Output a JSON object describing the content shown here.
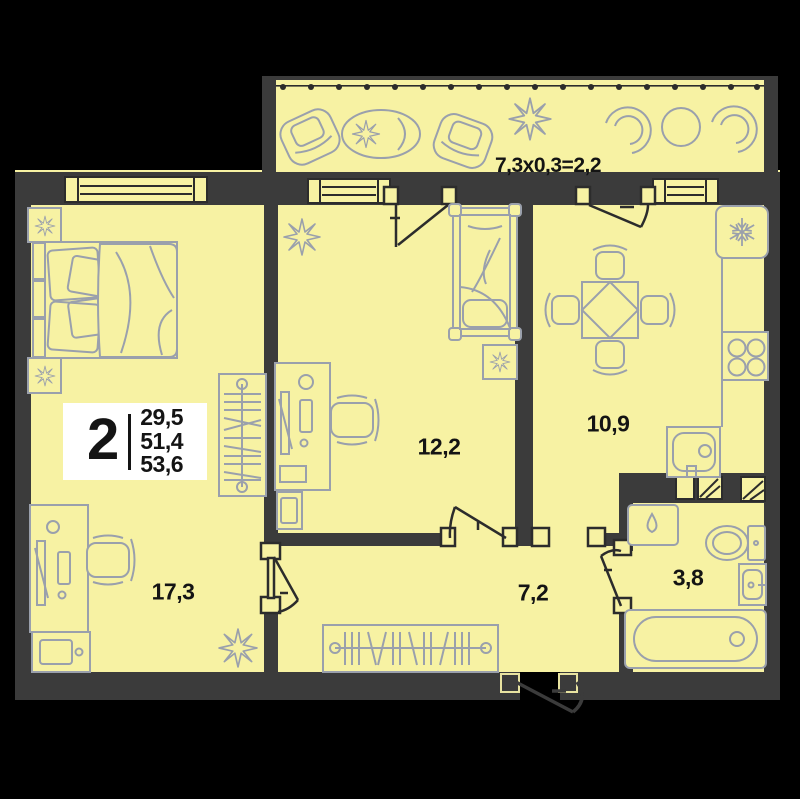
{
  "plan": {
    "balcony_formula": "7,3x0,3=2,2",
    "rooms": [
      {
        "name": "living-bedroom",
        "area": "17,3"
      },
      {
        "name": "bedroom",
        "area": "12,2"
      },
      {
        "name": "kitchen",
        "area": "10,9"
      },
      {
        "name": "hallway",
        "area": "7,2"
      },
      {
        "name": "bathroom",
        "area": "3,8"
      }
    ],
    "info": {
      "rooms_count": "2",
      "areas": [
        "29,5",
        "51,4",
        "53,6"
      ]
    },
    "icons": {
      "fridge": "snowflake-icon",
      "washing_machine": "water-drop-icon",
      "plants": "plant-star-icon"
    },
    "colors": {
      "background": "#000000",
      "floor": "#F7F2A3",
      "wall": "#3B3B3B",
      "furniture_line": "#9AA0AC",
      "door_line": "#2C2C2C",
      "info_box_bg": "#FFFFFF",
      "text": "#141414"
    }
  }
}
